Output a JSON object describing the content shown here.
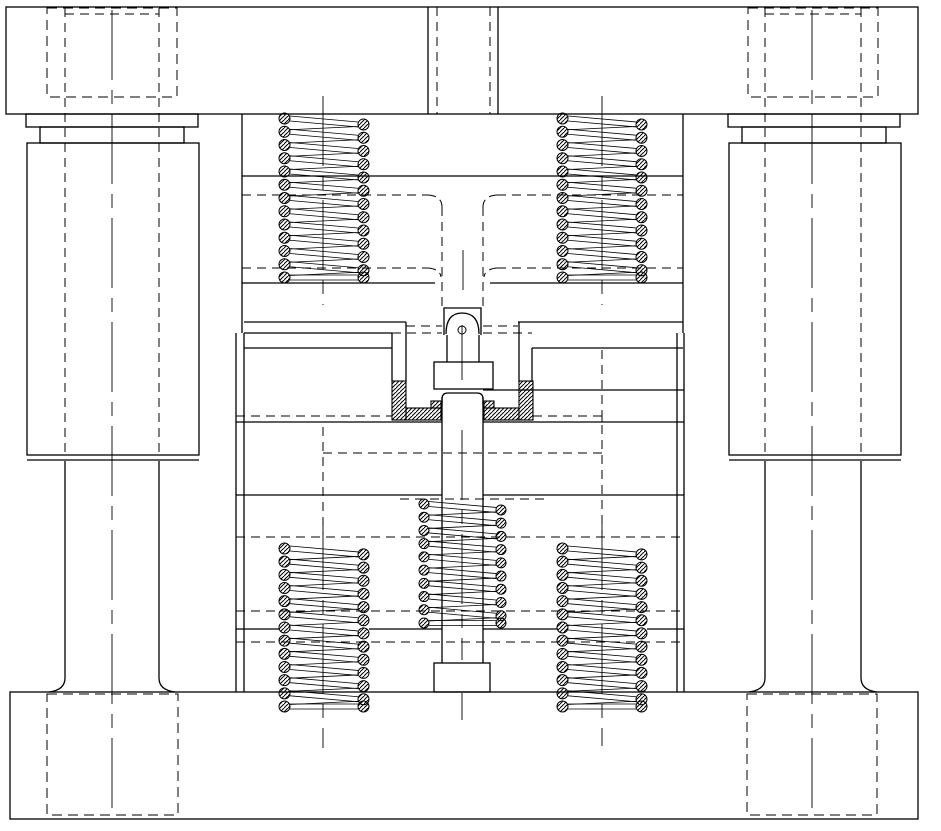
{
  "drawing": {
    "canvas": {
      "width": 941,
      "height": 831,
      "background": "#ffffff",
      "line_color": "#000000"
    },
    "components": [
      "upper-die-set-plate",
      "lower-die-set-plate",
      "die-shank",
      "guide-bushing-left",
      "guide-bushing-right",
      "guide-pillar-left",
      "guide-pillar-right",
      "hidden-counterbore-top-left",
      "hidden-counterbore-top-right",
      "hidden-pillar-pocket-bottom-left",
      "hidden-pillar-pocket-bottom-right",
      "stripper-spring-upper-left",
      "stripper-spring-upper-right",
      "ejector-spring-lower-left",
      "ejector-spring-lower-right",
      "center-ejector-spring",
      "ejector-rod",
      "punch",
      "die-insert-hatched"
    ],
    "geometry": {
      "rects": [
        {
          "name": "top-plate",
          "x": 6,
          "y": 7,
          "w": 912,
          "h": 107
        },
        {
          "name": "bottom-plate",
          "x": 10,
          "y": 692,
          "w": 908,
          "h": 127
        },
        {
          "name": "bushing-left-flange",
          "x": 26,
          "y": 114,
          "w": 172,
          "h": 13
        },
        {
          "name": "bushing-left-neck",
          "x": 40,
          "y": 127,
          "w": 144,
          "h": 16
        },
        {
          "name": "bushing-left-body",
          "x": 27,
          "y": 143,
          "w": 172,
          "h": 312
        },
        {
          "name": "bushing-right-flange",
          "x": 728,
          "y": 114,
          "w": 172,
          "h": 13
        },
        {
          "name": "bushing-right-neck",
          "x": 742,
          "y": 127,
          "w": 144,
          "h": 16
        },
        {
          "name": "bushing-right-body",
          "x": 729,
          "y": 143,
          "w": 172,
          "h": 312
        },
        {
          "name": "punch-shoulder",
          "x": 434,
          "y": 362,
          "w": 59,
          "h": 27
        },
        {
          "name": "ejector-rod-head",
          "x": 434,
          "y": 663,
          "w": 56,
          "h": 29
        }
      ],
      "solid_lines": [
        {
          "name": "shank-left-edge",
          "x1": 428,
          "y1": 7,
          "x2": 428,
          "y2": 114
        },
        {
          "name": "shank-right-edge",
          "x1": 498,
          "y1": 7,
          "x2": 498,
          "y2": 114
        },
        {
          "name": "upper-stack-left-edge",
          "x1": 242,
          "y1": 114,
          "x2": 242,
          "y2": 333
        },
        {
          "name": "upper-stack-right-edge",
          "x1": 683,
          "y1": 114,
          "x2": 683,
          "y2": 333
        },
        {
          "name": "upper-pad-boundary",
          "x1": 242,
          "y1": 176,
          "x2": 683,
          "y2": 176
        },
        {
          "name": "spring-seat-line-left",
          "x1": 242,
          "y1": 283,
          "x2": 435,
          "y2": 283
        },
        {
          "name": "spring-seat-line-right",
          "x1": 490,
          "y1": 283,
          "x2": 683,
          "y2": 283
        },
        {
          "name": "parting-line-left-a",
          "x1": 244,
          "y1": 322,
          "x2": 406,
          "y2": 322
        },
        {
          "name": "parting-line-right-a",
          "x1": 518,
          "y1": 322,
          "x2": 683,
          "y2": 322
        },
        {
          "name": "parting-line-left-b",
          "x1": 244,
          "y1": 333,
          "x2": 392,
          "y2": 333
        },
        {
          "name": "die-plate-top-left",
          "x1": 244,
          "y1": 348,
          "x2": 392,
          "y2": 348
        },
        {
          "name": "die-plate-top-right",
          "x1": 532,
          "y1": 348,
          "x2": 683,
          "y2": 348
        },
        {
          "name": "blank-line-right",
          "x1": 483,
          "y1": 390,
          "x2": 684,
          "y2": 390
        },
        {
          "name": "die-plate-bottom-left",
          "x1": 236,
          "y1": 422,
          "x2": 442,
          "y2": 422
        },
        {
          "name": "die-plate-bottom-right",
          "x1": 483,
          "y1": 422,
          "x2": 684,
          "y2": 422
        },
        {
          "name": "backing-plate-line-left",
          "x1": 236,
          "y1": 495,
          "x2": 442,
          "y2": 495
        },
        {
          "name": "backing-plate-line-right",
          "x1": 483,
          "y1": 495,
          "x2": 684,
          "y2": 495
        },
        {
          "name": "seat-plate-line-1",
          "x1": 236,
          "y1": 629,
          "x2": 279,
          "y2": 629
        },
        {
          "name": "seat-plate-line-2",
          "x1": 369,
          "y1": 629,
          "x2": 442,
          "y2": 629
        },
        {
          "name": "seat-plate-line-3",
          "x1": 483,
          "y1": 629,
          "x2": 557,
          "y2": 629
        },
        {
          "name": "seat-plate-line-4",
          "x1": 647,
          "y1": 629,
          "x2": 684,
          "y2": 629
        },
        {
          "name": "lower-stack-left-outer",
          "x1": 236,
          "y1": 333,
          "x2": 236,
          "y2": 692
        },
        {
          "name": "lower-stack-left-inner",
          "x1": 244,
          "y1": 333,
          "x2": 244,
          "y2": 692
        },
        {
          "name": "lower-stack-right-inner",
          "x1": 677,
          "y1": 333,
          "x2": 677,
          "y2": 692
        },
        {
          "name": "lower-stack-right-outer",
          "x1": 684,
          "y1": 333,
          "x2": 684,
          "y2": 692
        },
        {
          "name": "die-bore-wall-left-a",
          "x1": 392,
          "y1": 333,
          "x2": 392,
          "y2": 381
        },
        {
          "name": "die-bore-wall-left-b",
          "x1": 406,
          "y1": 322,
          "x2": 406,
          "y2": 381
        },
        {
          "name": "die-bore-wall-right-a",
          "x1": 532,
          "y1": 348,
          "x2": 532,
          "y2": 382
        },
        {
          "name": "die-bore-wall-right-b",
          "x1": 519,
          "y1": 322,
          "x2": 519,
          "y2": 382
        },
        {
          "name": "punch-neck-left",
          "x1": 447,
          "y1": 335,
          "x2": 447,
          "y2": 362
        },
        {
          "name": "punch-neck-right",
          "x1": 479,
          "y1": 335,
          "x2": 479,
          "y2": 362
        },
        {
          "name": "ejector-rod-left",
          "x1": 442,
          "y1": 397,
          "x2": 442,
          "y2": 663
        },
        {
          "name": "ejector-rod-right",
          "x1": 483,
          "y1": 397,
          "x2": 483,
          "y2": 663
        },
        {
          "name": "bushing-left-bottom",
          "x1": 27,
          "y1": 460,
          "x2": 199,
          "y2": 460
        },
        {
          "name": "bushing-right-bottom",
          "x1": 729,
          "y1": 460,
          "x2": 901,
          "y2": 460
        },
        {
          "name": "pillar-left-edge-a",
          "x1": 65,
          "y1": 461,
          "x2": 65,
          "y2": 678
        },
        {
          "name": "pillar-left-edge-b",
          "x1": 159,
          "y1": 461,
          "x2": 159,
          "y2": 678
        },
        {
          "name": "pillar-right-edge-a",
          "x1": 765,
          "y1": 461,
          "x2": 765,
          "y2": 678
        },
        {
          "name": "pillar-right-edge-b",
          "x1": 861,
          "y1": 461,
          "x2": 861,
          "y2": 678
        }
      ],
      "paths": [
        {
          "name": "punch-guide-bore",
          "d": "M444,335 L444,308 L481,308 L481,335"
        },
        {
          "name": "punch-nose-dome",
          "d": "M446,334 Q446,313 462,313 Q479,313 479,334"
        },
        {
          "name": "punch-stem-cap",
          "d": "M442,405 L442,399 Q442,393 448,393 L477,393 Q483,393 483,399 L483,405"
        },
        {
          "name": "pillar-left-flare-l",
          "d": "M65,678 C65,688 57,691 49,692"
        },
        {
          "name": "pillar-left-flare-r",
          "d": "M159,678 C159,688 167,691 175,692"
        },
        {
          "name": "pillar-right-flare-l",
          "d": "M765,678 C765,688 757,691 749,692"
        },
        {
          "name": "pillar-right-flare-r",
          "d": "M861,678 C861,688 869,691 877,692"
        }
      ],
      "hatch_rects": [
        {
          "name": "die-insert-left-column",
          "x": 392,
          "y": 381,
          "w": 14,
          "h": 39
        },
        {
          "name": "die-insert-left-strip",
          "x": 406,
          "y": 408,
          "w": 35,
          "h": 12
        },
        {
          "name": "die-insert-left-step",
          "x": 431,
          "y": 401,
          "w": 10,
          "h": 7
        },
        {
          "name": "die-insert-right-column",
          "x": 519,
          "y": 381,
          "w": 14,
          "h": 39
        },
        {
          "name": "die-insert-right-strip",
          "x": 484,
          "y": 408,
          "w": 35,
          "h": 12
        },
        {
          "name": "die-insert-right-step",
          "x": 484,
          "y": 401,
          "w": 10,
          "h": 7
        }
      ],
      "dashed_rects": [
        {
          "name": "hidden-counterbore-top-left",
          "x": 47,
          "y": 8,
          "w": 130,
          "h": 89
        },
        {
          "name": "hidden-counterbore-top-right",
          "x": 748,
          "y": 8,
          "w": 130,
          "h": 89
        },
        {
          "name": "hidden-pocket-bottom-left",
          "x": 47,
          "y": 694,
          "w": 131,
          "h": 121
        },
        {
          "name": "hidden-pocket-bottom-right",
          "x": 747,
          "y": 694,
          "w": 130,
          "h": 121
        }
      ],
      "dashed_lines": [
        {
          "name": "shank-hidden-left",
          "x1": 437,
          "y1": 7,
          "x2": 437,
          "y2": 114
        },
        {
          "name": "shank-hidden-right",
          "x1": 490,
          "y1": 7,
          "x2": 490,
          "y2": 114
        },
        {
          "name": "pillar-hidden-left-a",
          "x1": 65,
          "y1": 8,
          "x2": 65,
          "y2": 455
        },
        {
          "name": "pillar-hidden-left-b",
          "x1": 159,
          "y1": 8,
          "x2": 159,
          "y2": 455
        },
        {
          "name": "pillar-hidden-right-a",
          "x1": 765,
          "y1": 8,
          "x2": 765,
          "y2": 455
        },
        {
          "name": "pillar-hidden-right-b",
          "x1": 861,
          "y1": 8,
          "x2": 861,
          "y2": 455
        },
        {
          "name": "counterbore-inner-top-left",
          "x1": 65,
          "y1": 14,
          "x2": 159,
          "y2": 14
        },
        {
          "name": "counterbore-inner-top-right",
          "x1": 765,
          "y1": 14,
          "x2": 861,
          "y2": 14
        },
        {
          "name": "hidden-pocket-line-195-l",
          "x1": 242,
          "y1": 195,
          "x2": 428,
          "y2": 195
        },
        {
          "name": "hidden-pocket-line-195-r",
          "x1": 497,
          "y1": 195,
          "x2": 683,
          "y2": 195
        },
        {
          "name": "hidden-pocket-line-268-l",
          "x1": 242,
          "y1": 268,
          "x2": 428,
          "y2": 268
        },
        {
          "name": "hidden-pocket-line-268-r",
          "x1": 497,
          "y1": 268,
          "x2": 683,
          "y2": 268
        },
        {
          "name": "hidden-pocket-wall-left",
          "x1": 442,
          "y1": 207,
          "x2": 442,
          "y2": 308
        },
        {
          "name": "hidden-pocket-wall-right",
          "x1": 483,
          "y1": 207,
          "x2": 483,
          "y2": 308
        },
        {
          "name": "hidden-line-326-left",
          "x1": 406,
          "y1": 326,
          "x2": 442,
          "y2": 326
        },
        {
          "name": "hidden-line-326-right",
          "x1": 483,
          "y1": 326,
          "x2": 518,
          "y2": 326
        },
        {
          "name": "hidden-line-333-left",
          "x1": 392,
          "y1": 333,
          "x2": 442,
          "y2": 333
        },
        {
          "name": "hidden-line-333-right",
          "x1": 483,
          "y1": 333,
          "x2": 532,
          "y2": 333
        },
        {
          "name": "hidden-line-416-left",
          "x1": 236,
          "y1": 416,
          "x2": 392,
          "y2": 416
        },
        {
          "name": "hidden-line-416-right",
          "x1": 533,
          "y1": 416,
          "x2": 602,
          "y2": 416
        },
        {
          "name": "hidden-box-453",
          "x1": 323,
          "y1": 453,
          "x2": 602,
          "y2": 453
        },
        {
          "name": "hidden-box-wall-left",
          "x1": 323,
          "y1": 427,
          "x2": 323,
          "y2": 535
        },
        {
          "name": "hidden-box-wall-right",
          "x1": 602,
          "y1": 350,
          "x2": 602,
          "y2": 535
        },
        {
          "name": "spring-pocket-line-499",
          "x1": 400,
          "y1": 499,
          "x2": 545,
          "y2": 499
        },
        {
          "name": "hidden-line-537",
          "x1": 236,
          "y1": 537,
          "x2": 684,
          "y2": 537
        },
        {
          "name": "hidden-line-611",
          "x1": 236,
          "y1": 611,
          "x2": 684,
          "y2": 611
        },
        {
          "name": "hidden-line-642",
          "x1": 236,
          "y1": 642,
          "x2": 684,
          "y2": 642
        }
      ],
      "dashed_paths": [
        {
          "name": "pocket-corner-195-left",
          "d": "M428,195 Q442,196 442,207"
        },
        {
          "name": "pocket-corner-195-right",
          "d": "M497,195 Q483,196 483,207"
        },
        {
          "name": "pocket-corner-268-left",
          "d": "M428,268 Q440,269 441,277"
        },
        {
          "name": "pocket-corner-268-right",
          "d": "M497,268 Q485,269 484,277"
        },
        {
          "name": "pocket-corner-416-right",
          "d": "M602,416 Q602,416 602,422"
        }
      ],
      "center_lines": [
        {
          "name": "pillar-left-centerline",
          "x1": 112,
          "y1": 10,
          "x2": 112,
          "y2": 816
        },
        {
          "name": "pillar-right-centerline",
          "x1": 812,
          "y1": 10,
          "x2": 812,
          "y2": 816
        },
        {
          "name": "spring-ul-centerline",
          "x1": 323,
          "y1": 96,
          "x2": 323,
          "y2": 305
        },
        {
          "name": "spring-ur-centerline",
          "x1": 602,
          "y1": 96,
          "x2": 602,
          "y2": 305
        },
        {
          "name": "spring-ll-centerline",
          "x1": 323,
          "y1": 520,
          "x2": 323,
          "y2": 748
        },
        {
          "name": "spring-lr-centerline",
          "x1": 602,
          "y1": 520,
          "x2": 602,
          "y2": 746
        },
        {
          "name": "punch-centerline-a",
          "x1": 463,
          "y1": 250,
          "x2": 463,
          "y2": 290
        },
        {
          "name": "punch-centerline-b",
          "x1": 462,
          "y1": 325,
          "x2": 462,
          "y2": 380
        },
        {
          "name": "rod-centerline",
          "x1": 462,
          "y1": 430,
          "x2": 462,
          "y2": 660
        },
        {
          "name": "rod-head-centerline",
          "x1": 462,
          "y1": 693,
          "x2": 462,
          "y2": 720
        }
      ],
      "circles": [
        {
          "name": "punch-nose-hook",
          "cx": 462,
          "cy": 330,
          "r": 4
        }
      ],
      "springs": [
        {
          "name": "spring-upper-left",
          "x": 279,
          "y": 113,
          "w": 90,
          "h": 170,
          "coils": 13,
          "d": 11
        },
        {
          "name": "spring-upper-right",
          "x": 557,
          "y": 113,
          "w": 90,
          "h": 170,
          "coils": 13,
          "d": 11
        },
        {
          "name": "spring-lower-left",
          "x": 279,
          "y": 543,
          "w": 90,
          "h": 169,
          "coils": 13,
          "d": 11
        },
        {
          "name": "spring-lower-right",
          "x": 557,
          "y": 543,
          "w": 90,
          "h": 169,
          "coils": 13,
          "d": 11
        },
        {
          "name": "spring-center-ejector",
          "x": 419,
          "y": 499,
          "w": 87,
          "h": 129,
          "coils": 10,
          "d": 10
        }
      ]
    }
  }
}
